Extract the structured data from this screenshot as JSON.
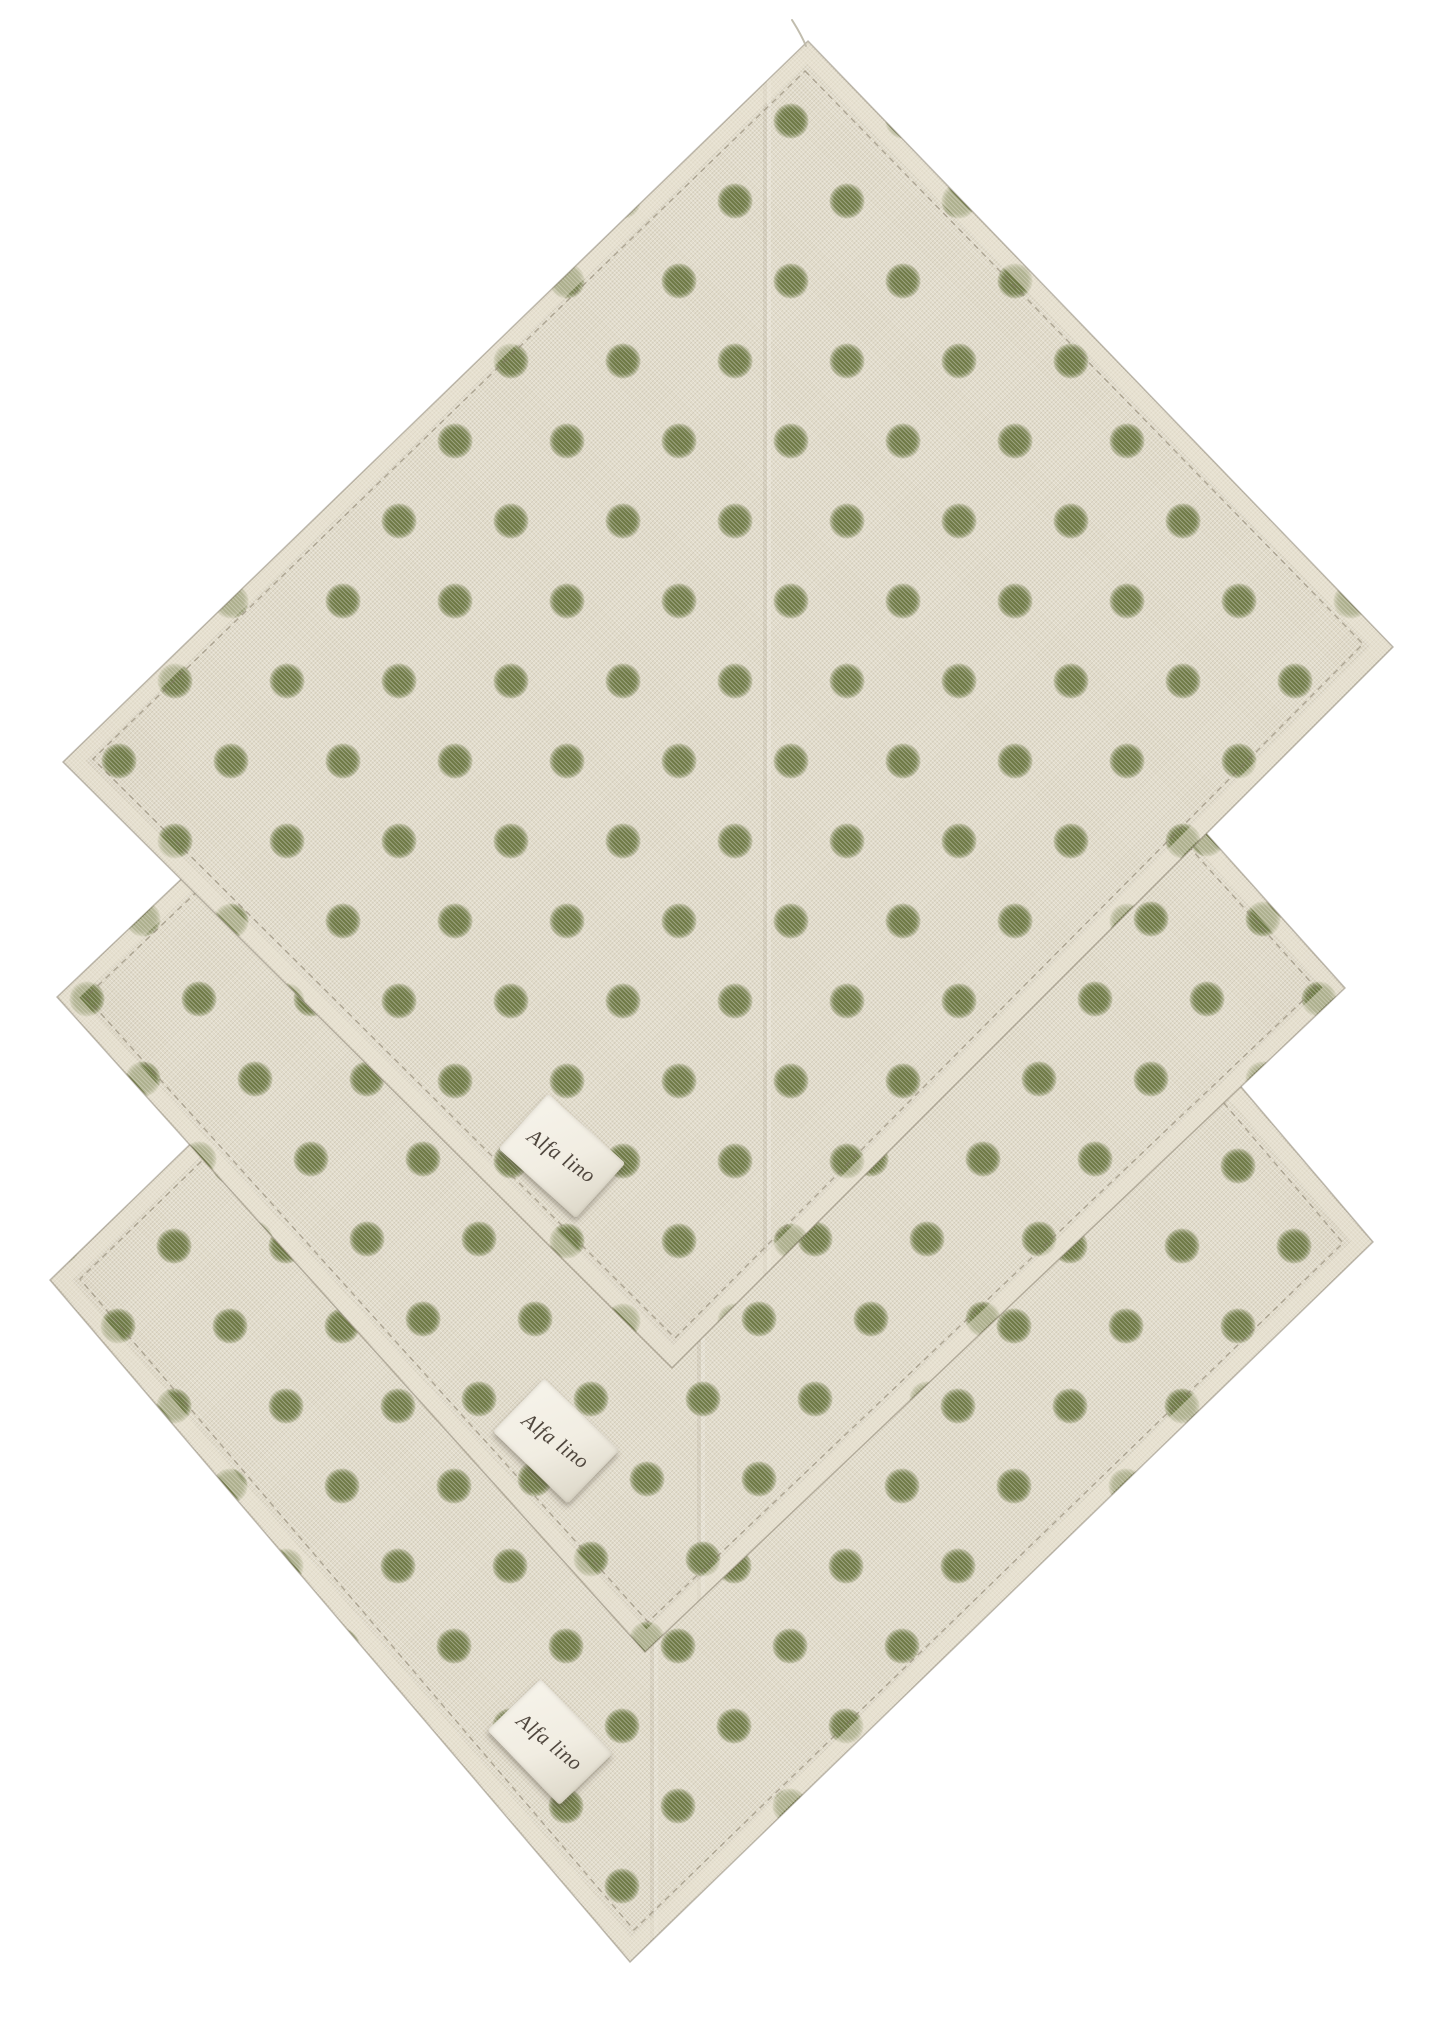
{
  "scene": {
    "type": "product-photo",
    "background_color": "#ffffff",
    "napkin_count": 3,
    "napkins": [
      {
        "position": "top-front",
        "orientation": "diamond"
      },
      {
        "position": "middle",
        "orientation": "diamond"
      },
      {
        "position": "bottom-back",
        "orientation": "diamond"
      }
    ]
  },
  "fabric": {
    "material_look": "natural linen weave",
    "base_color": "#e2dccb",
    "dot_color": "#68753e",
    "dot_diameter_px": 36,
    "dot_pitch_x_px": 112,
    "dot_row_pitch_px": 80,
    "pattern": "staggered polka dots"
  },
  "tags": {
    "count": 3,
    "items": [
      {
        "text": "Alfa lino"
      },
      {
        "text": "Alfa lino"
      },
      {
        "text": "Alfa lino"
      }
    ]
  },
  "css_vars": {
    "--page-bg": "#ffffff",
    "--linen": "#e2dccb",
    "--tag-bg": "#f1ede2",
    "--tag-ink": "#4f463d"
  }
}
